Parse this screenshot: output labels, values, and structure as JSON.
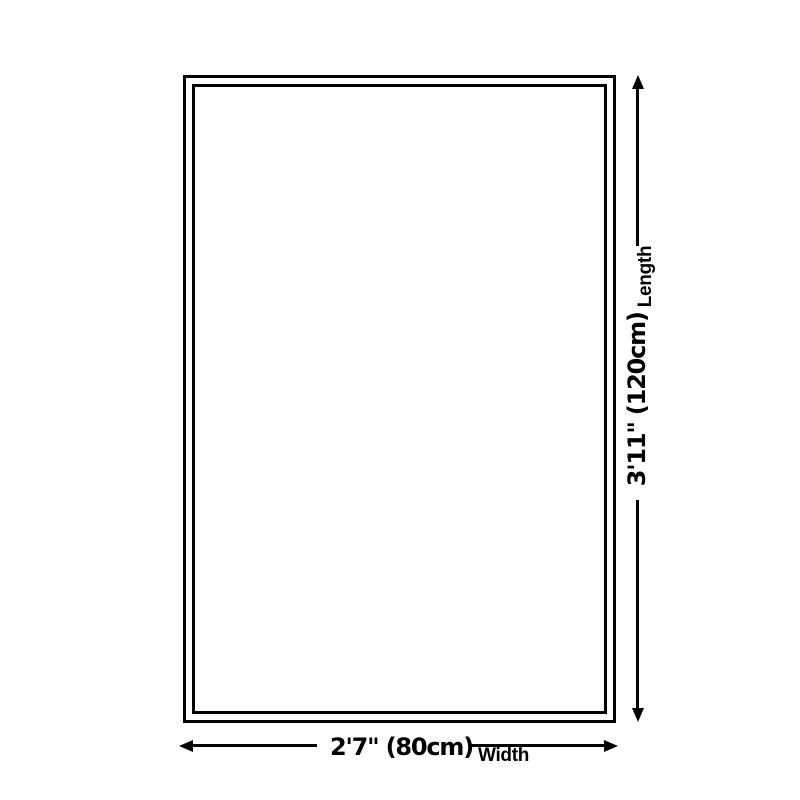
{
  "page": {
    "background_color": "#ffffff",
    "stroke_color": "#000000"
  },
  "diagram": {
    "type": "product-size-diagram",
    "shape": "rectangle-double-border",
    "length_dimension": {
      "value": "3'11\" (120cm)",
      "label": "Length",
      "orientation": "vertical",
      "arrow": "double-headed"
    },
    "width_dimension": {
      "value": "2'7\" (80cm)",
      "label": "Width",
      "orientation": "horizontal",
      "arrow": "double-headed"
    }
  }
}
